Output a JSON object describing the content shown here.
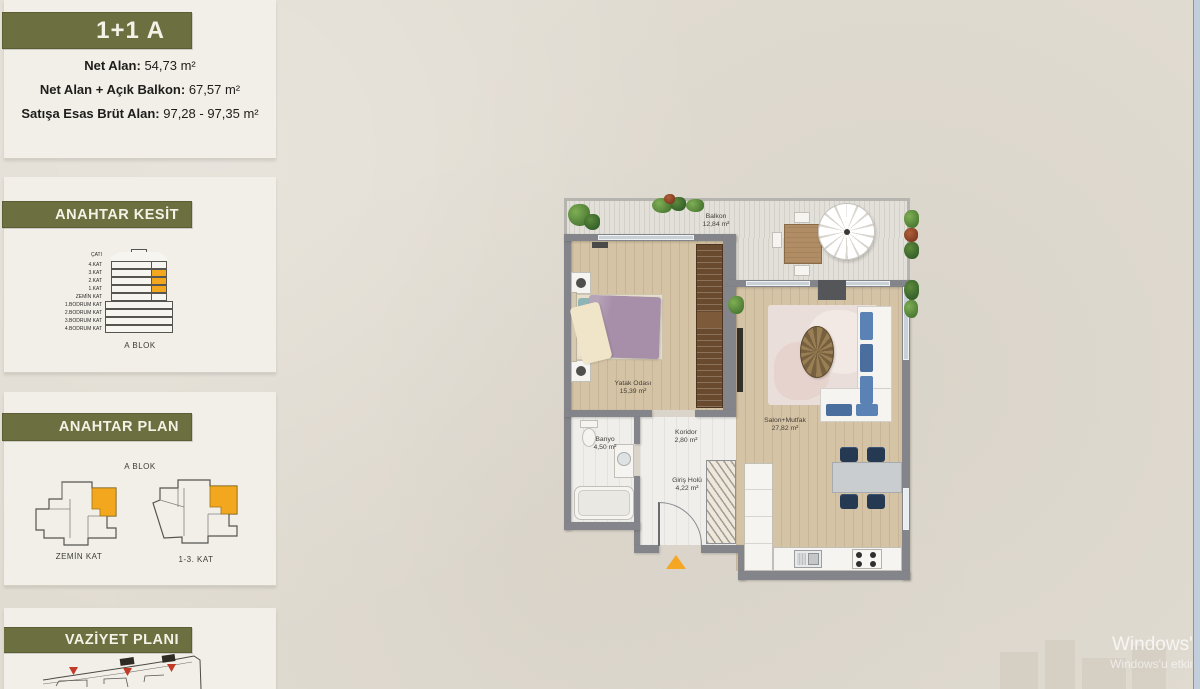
{
  "sidebar": {
    "unit_card": {
      "title": "1+1 A",
      "stats": [
        {
          "label": "Net Alan:",
          "value": "54,73 m²"
        },
        {
          "label": "Net Alan + Açık Balkon:",
          "value": "67,57 m²"
        },
        {
          "label": "Satışa Esas Brüt Alan:",
          "value": "97,28 - 97,35 m²"
        }
      ]
    },
    "section_card": {
      "title": "ANAHTAR KESİT",
      "block_label": "A BLOK",
      "floors": [
        "ÇATI",
        "4.KAT",
        "3.KAT",
        "2.KAT",
        "1.KAT",
        "ZEMİN KAT",
        "1.BODRUM KAT",
        "2.BODRUM KAT",
        "3.BODRUM KAT",
        "4.BODRUM KAT"
      ]
    },
    "keyplan_card": {
      "title": "ANAHTAR PLAN",
      "block_label": "A BLOK",
      "plans": [
        {
          "label": "ZEMİN KAT"
        },
        {
          "label": "1-3. KAT"
        }
      ]
    },
    "siteplan_card": {
      "title": "VAZİYET PLANI"
    }
  },
  "floorplan": {
    "rooms": [
      {
        "name": "Balkon",
        "area": "12,84 m²"
      },
      {
        "name": "Yatak Odası",
        "area": "15,39 m²"
      },
      {
        "name": "Banyo",
        "area": "4,50 m²"
      },
      {
        "name": "Koridor",
        "area": "2,80 m²"
      },
      {
        "name": "Giriş Holü",
        "area": "4,22 m²"
      },
      {
        "name": "Salon+Mutfak",
        "area": "27,82 m²"
      }
    ]
  },
  "watermark": {
    "line1": "Windows'u Et",
    "line2": "Windows'u etkinleş"
  },
  "colors": {
    "accent_olive": "#6c6f3f",
    "highlight_orange": "#f3a71e",
    "marker_red": "#c23b28",
    "wall_gray": "#83858a"
  }
}
